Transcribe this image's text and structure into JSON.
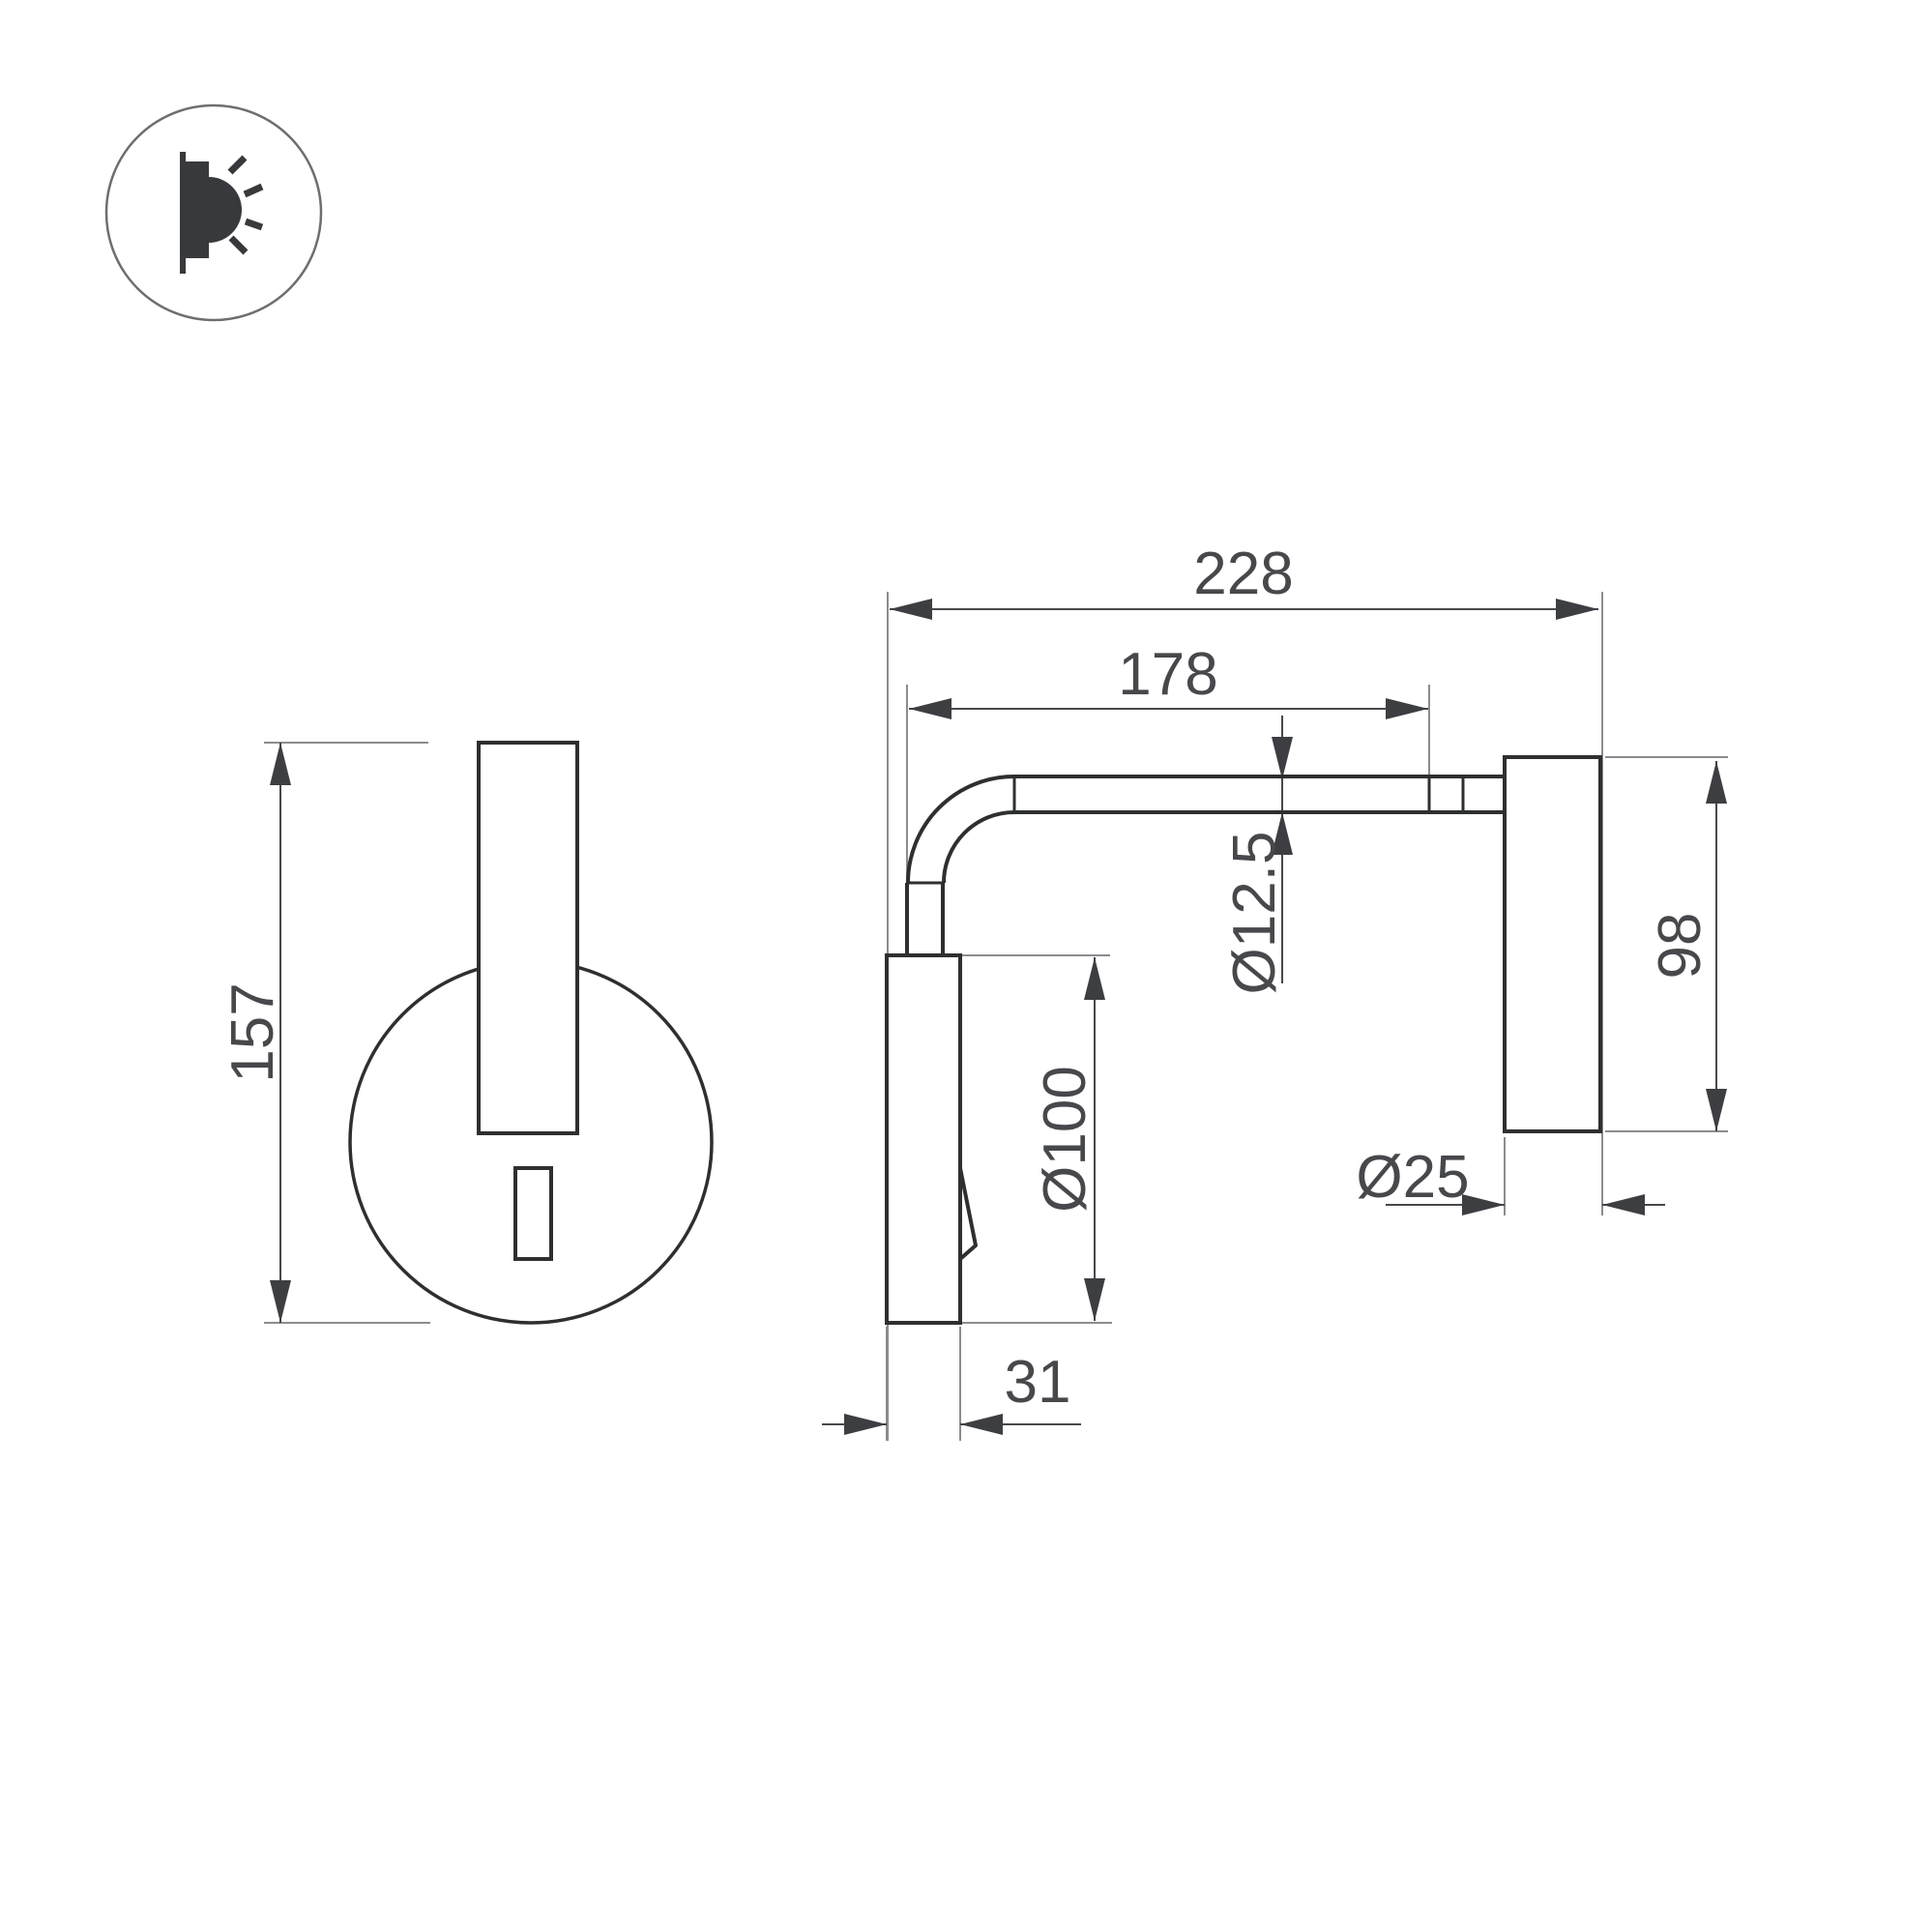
{
  "drawing": {
    "title": "wall-lamp-dimension-drawing",
    "icon": {
      "name": "wall-washer-light-icon"
    },
    "front_view": {
      "height": "157"
    },
    "side_view": {
      "overall_depth": "228",
      "arm_reach": "178",
      "tube_diameter": "Ø12.5",
      "base_diameter": "Ø100",
      "head_diameter": "Ø25",
      "head_length": "98",
      "base_depth": "31"
    },
    "colors": {
      "background": "#ffffff",
      "outline": "#2e2f31",
      "dimension_line": "#47484c",
      "extension_line": "#8b8c90",
      "text": "#47484c"
    }
  }
}
